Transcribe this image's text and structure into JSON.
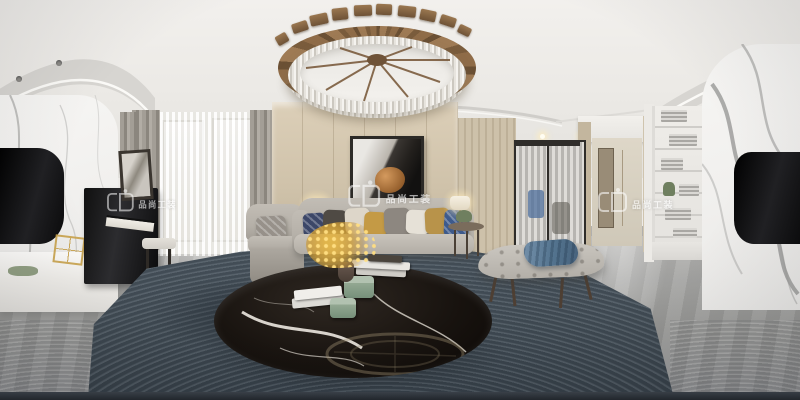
{
  "image": {
    "type": "equirectangular-360-panorama",
    "subject": "modern luxury living room interior render"
  },
  "watermark": {
    "text": "品尚工装",
    "logo": "rounded-monogram-outline",
    "color": "rgba(255,255,255,0.62)",
    "instances": 3
  },
  "palette": {
    "ceiling": "#edebe8",
    "cove_shadow": "#d7d5d1",
    "marble_base": "#f4f3f1",
    "marble_vein": "#8d8d8b",
    "beige_wall": "#cfc2aa",
    "curtain_gray": "#9b968e",
    "sheer_white": "#e9e7e3",
    "sofa_gray": "#b5b0a8",
    "pillow_navy": "#3c4768",
    "pillow_gold": "#c49a45",
    "pillow_blue": "#3d5a8c",
    "chandelier_wood": "#8a6848",
    "piano_black": "#151515",
    "tv_black": "#0b0b0b",
    "table_black": "#18130f",
    "rug_slate": "#46515a",
    "floor_gray": "#a8a8a6",
    "bench_gray": "#bcb8b1",
    "blanket_blue": "#5f7e99",
    "flower_gold": "#d6a93a",
    "decor_green": "#8ba291",
    "accent_brass": "#c9a24b"
  },
  "scene": {
    "objects": [
      "wood-crystal-ring-chandelier",
      "coved-ceiling-with-led-strips",
      "white-marble-tv-wall-left",
      "wall-mounted-tv-left",
      "upright-piano-with-bench",
      "leaning-framed-art",
      "gray-drapes-and-sheer-windows",
      "gray-fabric-armchair",
      "beige-paneled-feature-wall",
      "abstract-wall-painting",
      "light-gray-sofa-with-pillows",
      "white-drum-side-table-with-lamp",
      "round-wood-side-table-with-lamp",
      "black-framed-glass-partition",
      "hallway-with-recessed-lights",
      "built-in-white-bookshelf",
      "white-marble-tv-wall-right",
      "wall-mounted-tv-right",
      "tufted-bench-daybed",
      "blue-throw-blanket",
      "round-black-marble-coffee-table",
      "yellow-flower-arrangement",
      "sage-green-storage-boxes",
      "white-book-stacks",
      "slate-blue-area-rug",
      "gray-marble-floor",
      "white-marble-ledge-with-gold-decor"
    ]
  }
}
